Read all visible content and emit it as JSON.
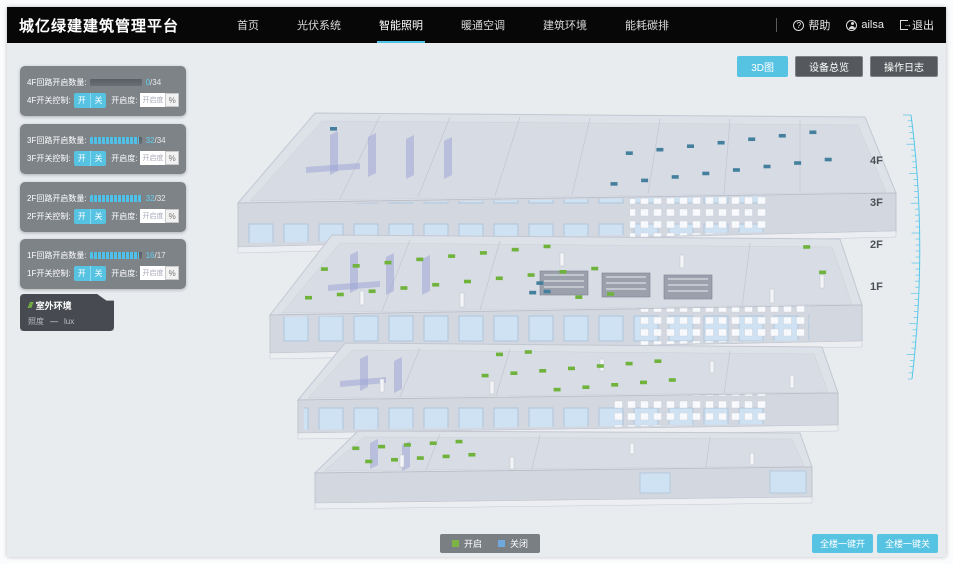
{
  "header": {
    "title": "城亿绿建建筑管理平台",
    "nav": [
      {
        "label": "首页",
        "active": false
      },
      {
        "label": "光伏系统",
        "active": false
      },
      {
        "label": "智能照明",
        "active": true
      },
      {
        "label": "暖通空调",
        "active": false
      },
      {
        "label": "建筑环境",
        "active": false
      },
      {
        "label": "能耗碳排",
        "active": false
      }
    ],
    "help_label": "帮助",
    "user_name": "ailsa",
    "logout_label": "退出"
  },
  "view_buttons": [
    {
      "label": "3D图",
      "active": true
    },
    {
      "label": "设备总览",
      "active": false
    },
    {
      "label": "操作日志",
      "active": false
    }
  ],
  "floor_panels": [
    {
      "circuit_label": "4F回路开启数量:",
      "open": "0",
      "total_display": "/34",
      "open_count": 0,
      "total_count": 34,
      "switch_label": "4F开关控制:",
      "on_label": "开",
      "off_label": "关",
      "dim_label": "开启度:",
      "dim_placeholder": "开启度",
      "unit": "%"
    },
    {
      "circuit_label": "3F回路开启数量:",
      "open": "32",
      "total_display": "/34",
      "open_count": 32,
      "total_count": 34,
      "switch_label": "3F开关控制:",
      "on_label": "开",
      "off_label": "关",
      "dim_label": "开启度:",
      "dim_placeholder": "开启度",
      "unit": "%"
    },
    {
      "circuit_label": "2F回路开启数量:",
      "open": "32",
      "total_display": "/32",
      "open_count": 32,
      "total_count": 32,
      "switch_label": "2F开关控制:",
      "on_label": "开",
      "off_label": "关",
      "dim_label": "开启度:",
      "dim_placeholder": "开启度",
      "unit": "%"
    },
    {
      "circuit_label": "1F回路开启数量:",
      "open": "16",
      "total_display": "/17",
      "open_count": 16,
      "total_count": 17,
      "switch_label": "1F开关控制:",
      "on_label": "开",
      "off_label": "关",
      "dim_label": "开启度:",
      "dim_placeholder": "开启度",
      "unit": "%"
    }
  ],
  "outdoor_panel": {
    "title": "室外环境",
    "metric_label": "照度",
    "value": "—",
    "unit": "lux"
  },
  "floor_labels": [
    "4F",
    "3F",
    "2F",
    "1F"
  ],
  "legend": {
    "on_label": "开启",
    "off_label": "关闭",
    "on_color": "#7cb342",
    "off_color": "#6fa8dc"
  },
  "bulk_buttons": [
    {
      "label": "全楼一键开"
    },
    {
      "label": "全楼一键关"
    }
  ],
  "colors": {
    "accent": "#57c3e2",
    "header_bg": "#070708",
    "indicator_on": "#6fb33c",
    "indicator_off": "#44809d"
  }
}
